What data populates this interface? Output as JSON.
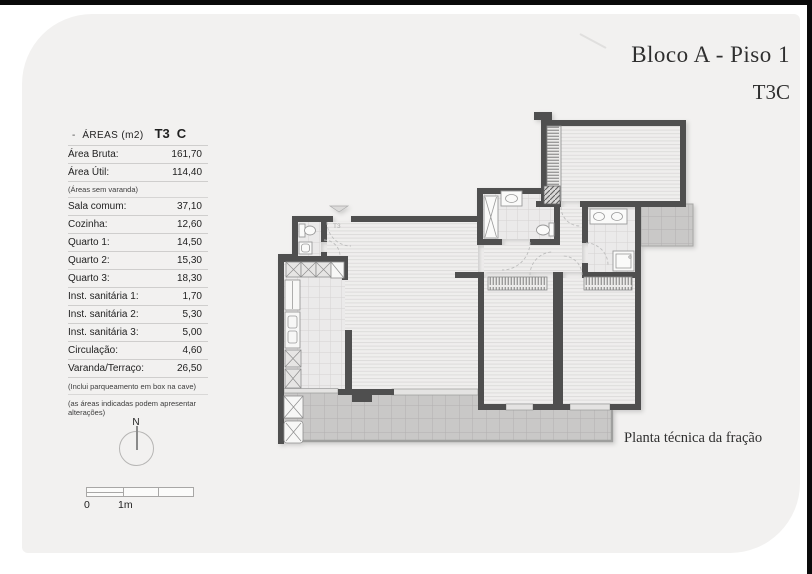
{
  "page": {
    "title_line1": "Bloco A - Piso 1",
    "title_line2": "T3C",
    "plan_caption": "Planta técnica da fração",
    "entry_label": "T3"
  },
  "areas_table": {
    "header": {
      "dash": "-",
      "title": "ÁREAS (m2)",
      "type": "T3",
      "variant": "C"
    },
    "rows": [
      {
        "label": "Área Bruta:",
        "value": "161,70"
      },
      {
        "label": "Área Útil:",
        "value": "114,40"
      },
      {
        "label": "Sala comum:",
        "value": "37,10"
      },
      {
        "label": "Cozinha:",
        "value": "12,60"
      },
      {
        "label": "Quarto 1:",
        "value": "14,50"
      },
      {
        "label": "Quarto 2:",
        "value": "15,30"
      },
      {
        "label": "Quarto 3:",
        "value": "18,30"
      },
      {
        "label": "Inst. sanitária 1:",
        "value": "1,70"
      },
      {
        "label": "Inst. sanitária 2:",
        "value": "5,30"
      },
      {
        "label": "Inst. sanitária 3:",
        "value": "5,00"
      },
      {
        "label": "Circulação:",
        "value": "4,60"
      },
      {
        "label": "Varanda/Terraço:",
        "value": "26,50"
      }
    ],
    "inline_note": "(Áreas sem varanda)",
    "notes": [
      "(Inclui parqueamento em box na cave)",
      "(as áreas indicadas podem apresentar alterações)"
    ]
  },
  "compass": {
    "label": "N"
  },
  "scale_bar": {
    "label_start": "0",
    "label_first": "1m"
  },
  "colors": {
    "page_bg": "#ffffff",
    "edge_black": "#0a0a0a",
    "card_bg": "#f2f1f0",
    "wall": "#4f4f4f",
    "wood_floor": "#efeeed",
    "wood_line": "#dddcdb",
    "tile_floor": "#ebeaea",
    "tile_line": "#d4d3d2",
    "terrace": "#c9c8c7",
    "terrace_line": "#b2b1b0",
    "outline": "#9a9a9a",
    "door_arc": "#bdbdbd",
    "text": "#1f1f1f",
    "serif_ink": "#2f2f2f"
  }
}
